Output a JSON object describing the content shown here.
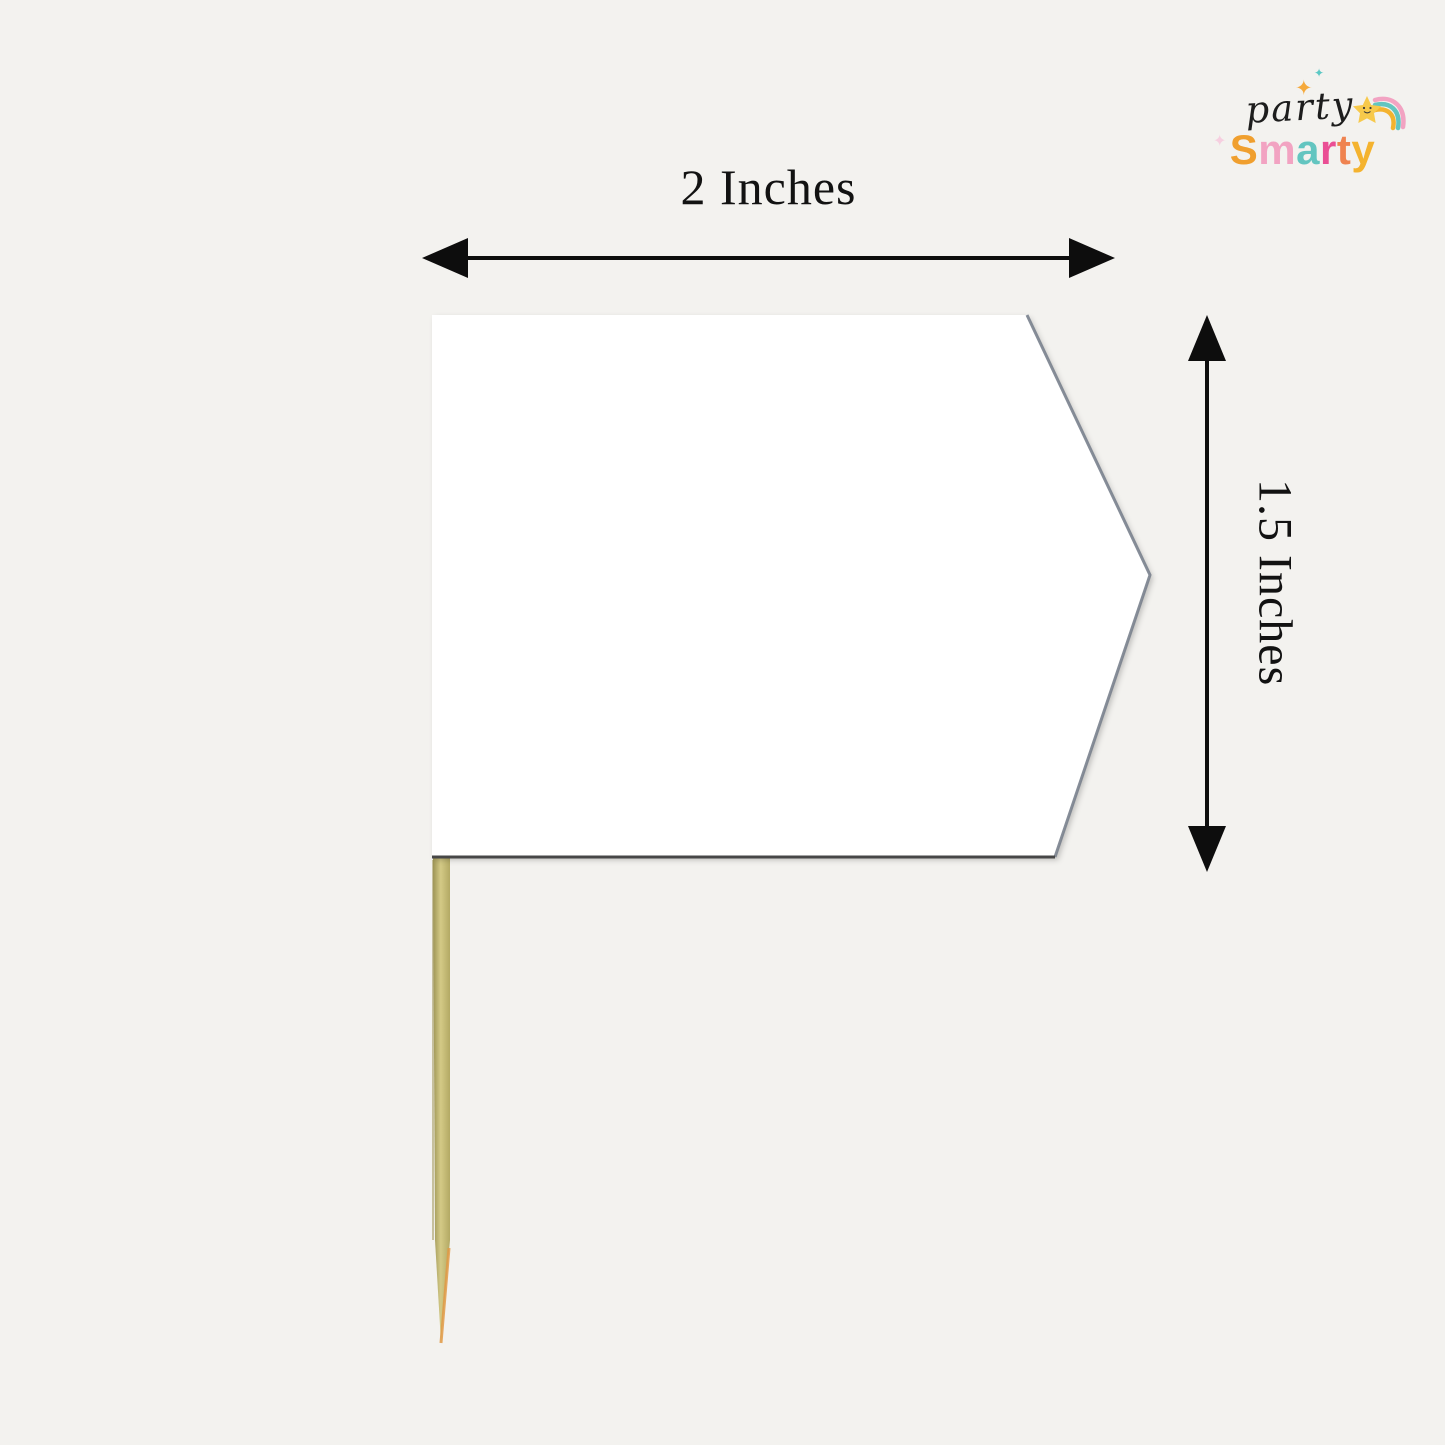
{
  "page": {
    "background_color": "#f3f2ef",
    "arrow_color": "#0d0d0d",
    "text_color": "#121212"
  },
  "dimensions": {
    "width": {
      "label": "2 Inches"
    },
    "height": {
      "label": "1.5 Inches"
    }
  },
  "product": {
    "flag_fill": "#ffffff",
    "flag_slant_edge_color": "#79818d",
    "flag_bottom_edge_color": "#474747",
    "stick_edge_color": "#9d9455",
    "stick_mid_color": "#d4ca86",
    "stick_right_color": "#b3a964",
    "stick_tip_color": "#e09a45"
  },
  "logo": {
    "script_text": "party",
    "script_color": "#1d1d1d",
    "brand_letters": [
      {
        "char": "S",
        "style": "color:#f09f2e"
      },
      {
        "char": "m",
        "style": "color:#f2a3c2"
      },
      {
        "char": "a",
        "style": "color:#63c5c0"
      },
      {
        "char": "r",
        "style": "color:#ea4e94"
      },
      {
        "char": "t",
        "style": "color:#ef8350"
      },
      {
        "char": "y",
        "style": "color:#f4b32f"
      }
    ],
    "star_color": "#f7c94b",
    "rainbow_colors": [
      "#f2a3c2",
      "#63c5c0",
      "#f4b32f"
    ],
    "sparkles": [
      {
        "glyph": "✦",
        "style": "color:#f5a93b"
      },
      {
        "glyph": "✦",
        "style": "color:#5bc8c4"
      },
      {
        "glyph": "✦",
        "style": "color:#f6cfe0"
      }
    ]
  }
}
